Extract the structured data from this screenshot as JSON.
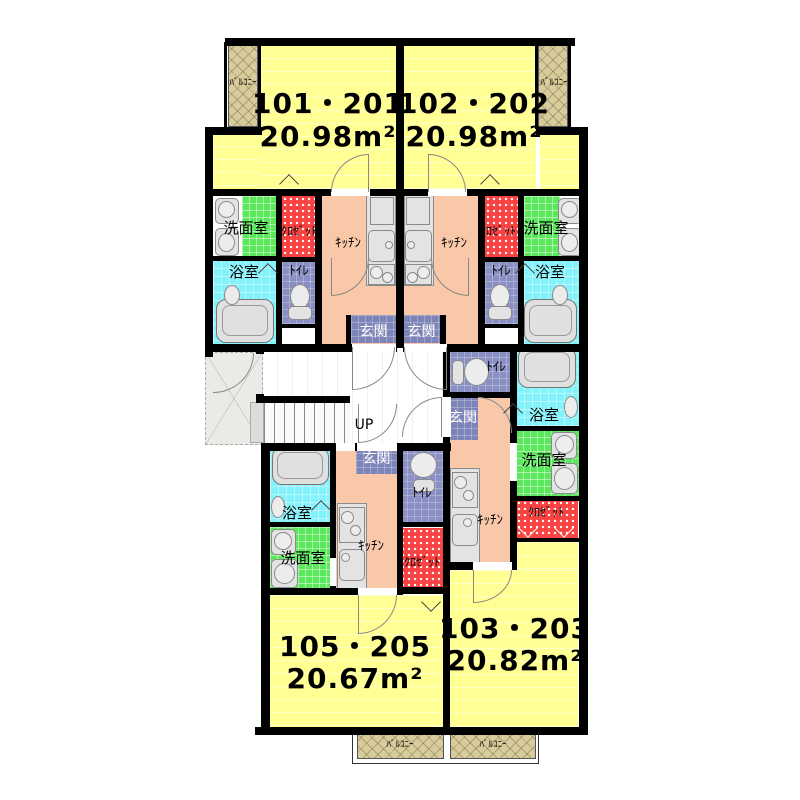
{
  "units": [
    {
      "name": "101・201",
      "area": "20.98m²"
    },
    {
      "name": "102・202",
      "area": "20.98m²"
    },
    {
      "name": "103・203",
      "area": "20.82m²"
    },
    {
      "name": "105・205",
      "area": "20.67m²"
    }
  ],
  "labels": {
    "washroom": "洗面室",
    "bathroom": "浴室",
    "toilet": "ﾄｲﾚ",
    "kitchen": "ｷｯﾁﾝ",
    "closet": "ｸﾛｾﾞｯﾄ",
    "entrance": "玄関",
    "balcony": "ﾊﾞﾙｺﾆｰ",
    "stairs_up": "UP"
  },
  "colors": {
    "living": "#ffff94",
    "kitchen": "#f8c8a8",
    "washroom": "#5ce85c",
    "bathroom": "#84f2fa",
    "toilet": "#8a90c4",
    "entrance_hall": "#7d84b8",
    "closet": "#f94343",
    "balcony": "#d8cc9c",
    "wall": "#000000"
  }
}
